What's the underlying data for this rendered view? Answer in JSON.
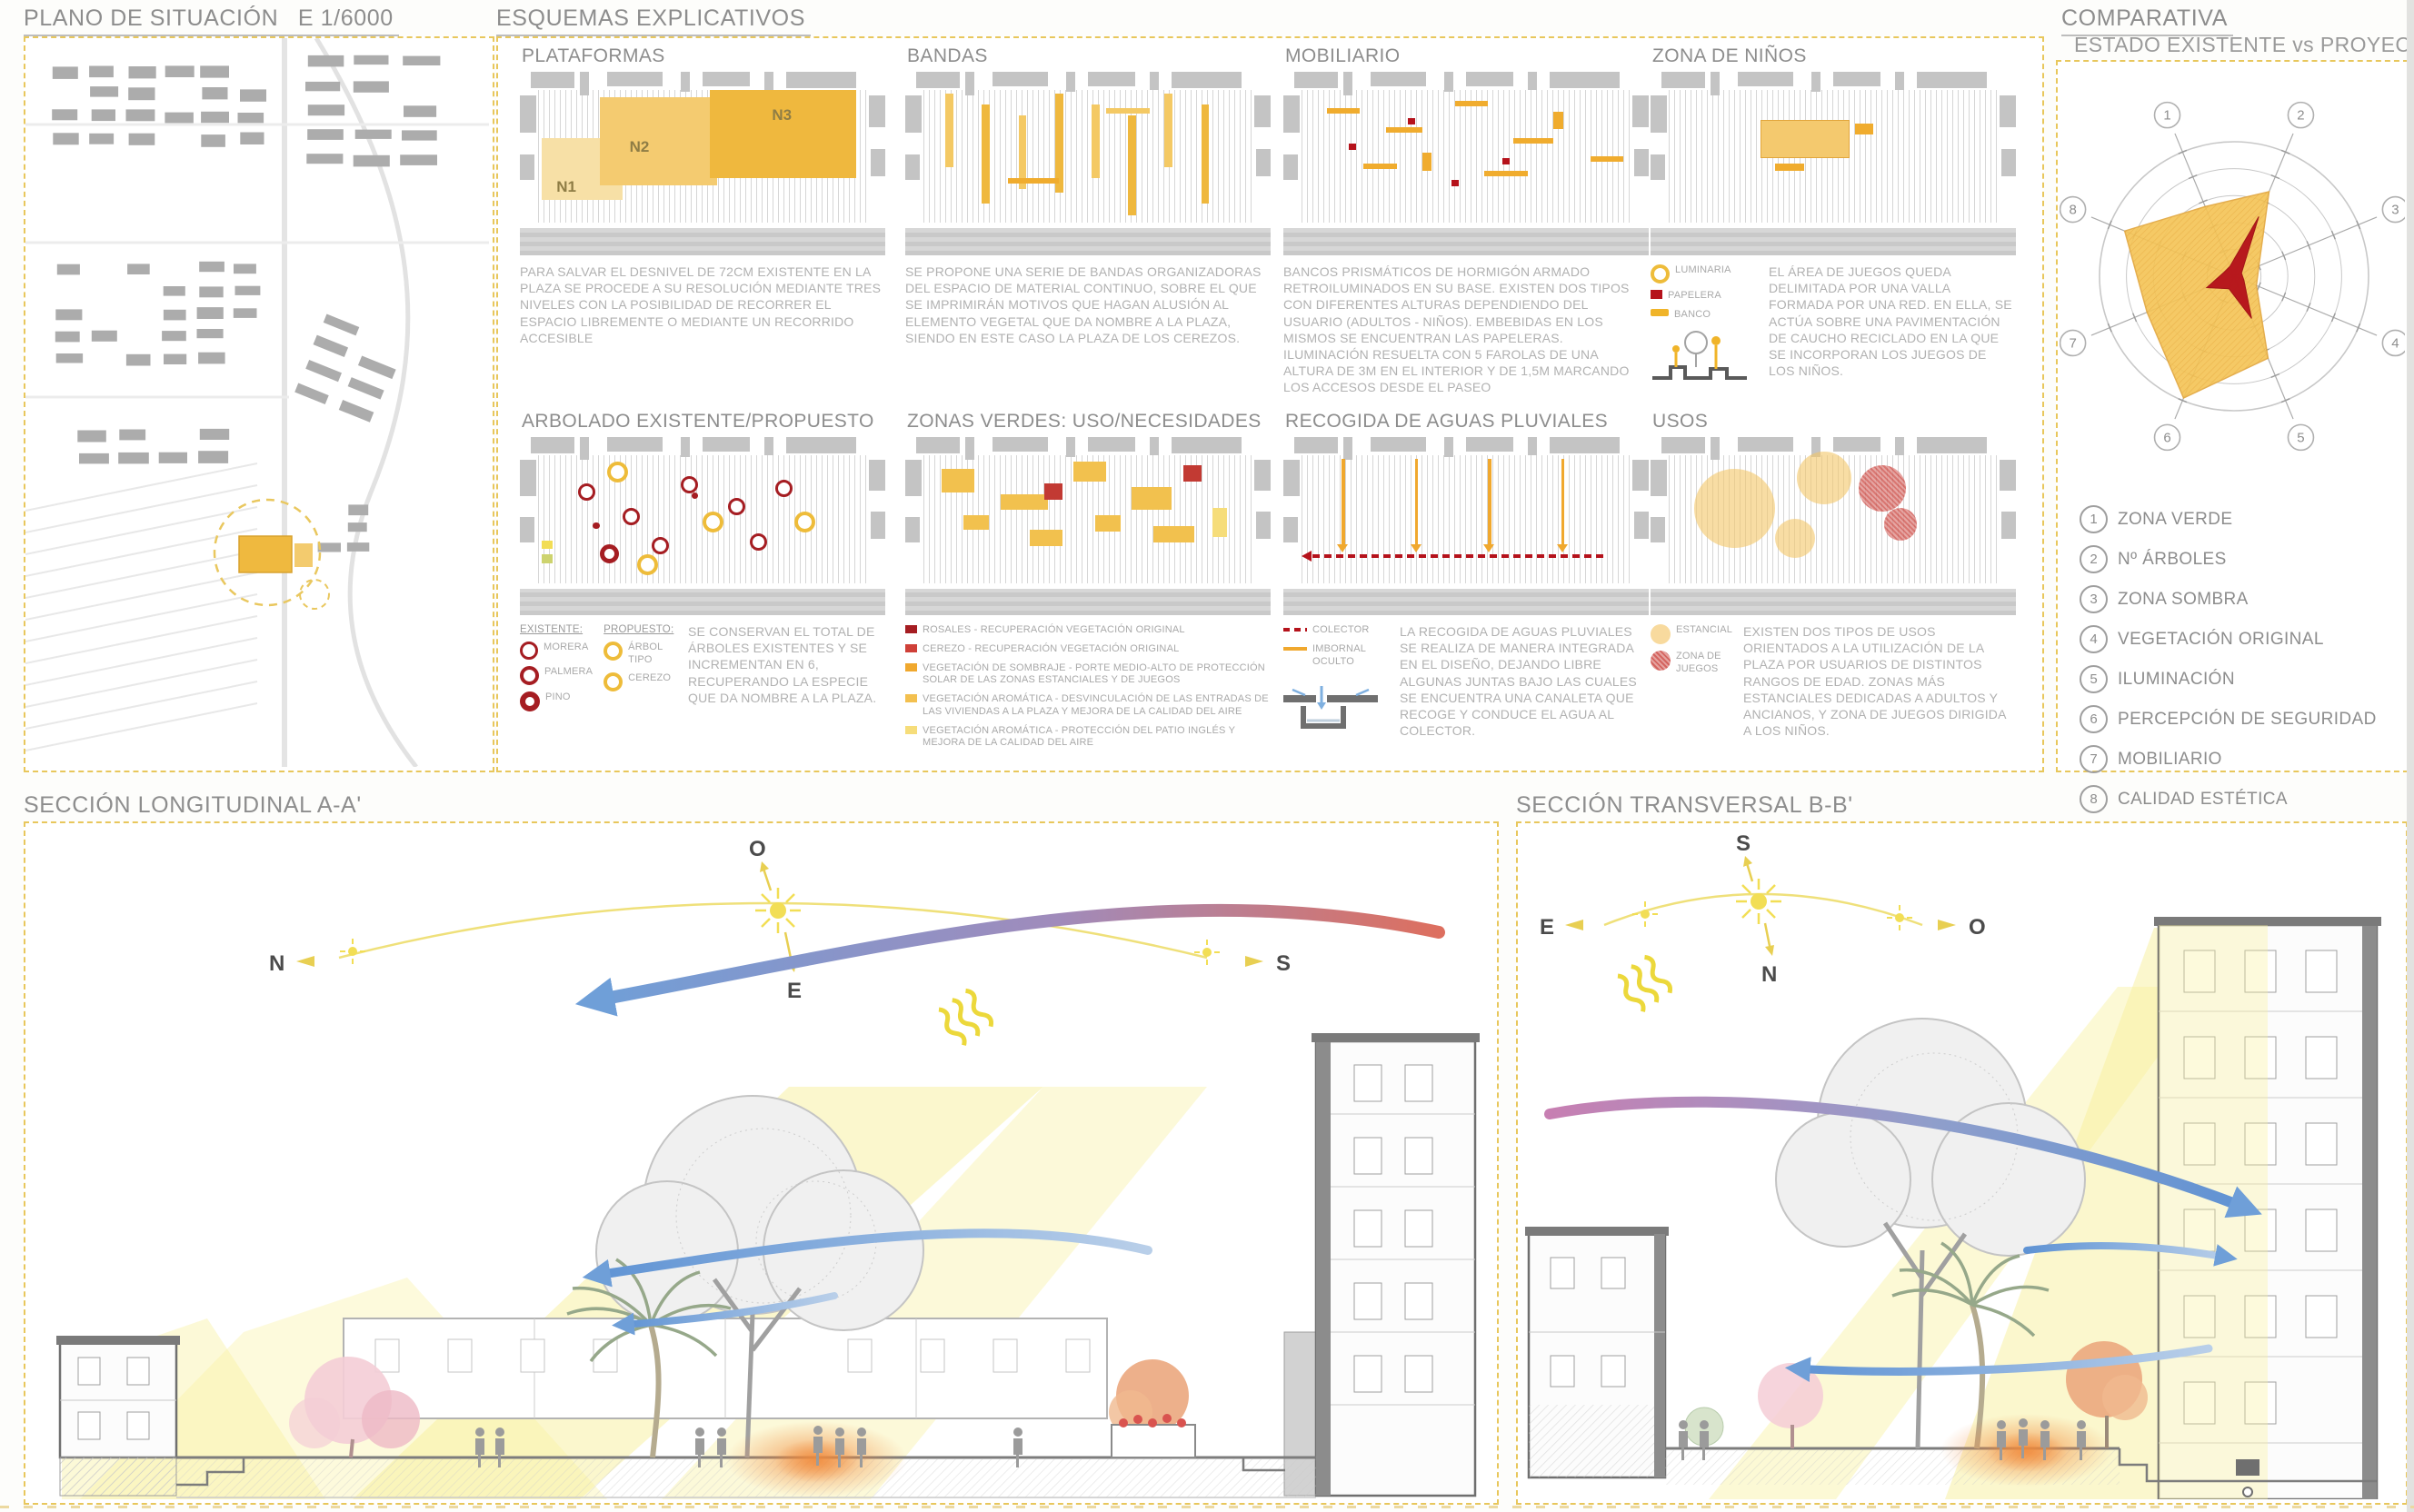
{
  "board": {
    "accent": "#e8c75c"
  },
  "site_plan": {
    "title": "PLANO DE SITUACIÓN",
    "scale": "E 1/6000"
  },
  "esquemas": {
    "title": "ESQUEMAS EXPLICATIVOS",
    "panels": [
      {
        "title": "PLATAFORMAS",
        "labels": [
          "N1",
          "N2",
          "N3"
        ],
        "text": "PARA SALVAR EL DESNIVEL DE 72CM EXISTENTE EN LA PLAZA SE PROCEDE A SU RESOLUCIÓN MEDIANTE TRES NIVELES CON LA POSIBILIDAD DE RECORRER EL ESPACIO LIBREMENTE O MEDIANTE UN RECORRIDO ACCESIBLE"
      },
      {
        "title": "BANDAS",
        "text": "SE PROPONE UNA SERIE DE BANDAS ORGANIZADORAS DEL ESPACIO DE MATERIAL CONTINUO, SOBRE EL QUE SE IMPRIMIRÁN MOTIVOS QUE HAGAN ALUSIÓN AL ELEMENTO VEGETAL QUE DA NOMBRE A LA PLAZA, SIENDO EN ESTE CASO LA PLAZA DE LOS CEREZOS."
      },
      {
        "title": "MOBILIARIO",
        "text": "BANCOS PRISMÁTICOS DE HORMIGÓN ARMADO RETROILUMINADOS EN SU BASE. EXISTEN DOS TIPOS CON DIFERENTES ALTURAS DEPENDIENDO DEL USUARIO (ADULTOS - NIÑOS). EMBEBIDAS EN LOS MISMOS SE ENCUENTRAN LAS PAPELERAS. ILUMINACIÓN RESUELTA CON 5 FAROLAS DE UNA ALTURA DE 3M EN EL INTERIOR Y DE 1,5M MARCANDO LOS ACCESOS DESDE EL PASEO",
        "legend": [
          "LUMINARIA",
          "PAPELERA",
          "BANCO"
        ]
      },
      {
        "title": "ZONA DE NIÑOS",
        "text": "EL ÁREA DE JUEGOS QUEDA DELIMITADA POR UNA VALLA FORMADA POR UNA RED. EN ELLA, SE ACTÚA SOBRE UNA PAVIMENTACIÓN DE CAUCHO RECICLADO EN LA QUE SE INCORPORAN LOS JUEGOS DE LOS NIÑOS."
      },
      {
        "title": "ARBOLADO EXISTENTE/PROPUESTO",
        "text": "SE CONSERVAN EL TOTAL DE ÁRBOLES EXISTENTES Y SE INCREMENTAN EN 6, RECUPERANDO LA ESPECIE QUE DA NOMBRE A LA PLAZA.",
        "legend_existente": {
          "title": "EXISTENTE:",
          "items": [
            "MORERA",
            "PALMERA",
            "PINO"
          ]
        },
        "legend_propuesto": {
          "title": "PROPUESTO:",
          "items": [
            "ÁRBOL TIPO",
            "CEREZO"
          ]
        }
      },
      {
        "title": "ZONAS VERDES: USO/NECESIDADES",
        "legend": [
          "ROSALES - RECUPERACIÓN VEGETACIÓN ORIGINAL",
          "CEREZO - RECUPERACIÓN VEGETACIÓN ORIGINAL",
          "VEGETACIÓN DE SOMBRAJE - PORTE MEDIO-ALTO DE PROTECCIÓN SOLAR DE LAS ZONAS ESTANCIALES Y DE JUEGOS",
          "VEGETACIÓN AROMÁTICA - DESVINCULACIÓN DE LAS ENTRADAS DE LAS VIVIENDAS A LA PLAZA Y MEJORA DE LA CALIDAD DEL AIRE",
          "VEGETACIÓN AROMÁTICA - PROTECCIÓN DEL PATIO INGLÉS Y MEJORA DE LA CALIDAD DEL AIRE"
        ]
      },
      {
        "title": "RECOGIDA DE AGUAS PLUVIALES",
        "legend": [
          "COLECTOR",
          "IMBORNAL OCULTO"
        ],
        "text": "LA RECOGIDA DE AGUAS PLUVIALES SE REALIZA DE MANERA INTEGRADA EN EL DISEÑO, DEJANDO LIBRE ALGUNAS JUNTAS BAJO LAS CUALES SE ENCUENTRA UNA CANALETA QUE RECOGE Y CONDUCE EL AGUA AL COLECTOR.",
        "legend_water_icon": "canaleta-section-icon"
      },
      {
        "title": "USOS",
        "legend": [
          "ESTANCIAL",
          "ZONA DE JUEGOS"
        ],
        "text": "EXISTEN DOS TIPOS DE USOS ORIENTADOS A LA UTILIZACIÓN DE LA PLAZA POR USUARIOS DE DISTINTOS RANGOS DE EDAD. ZONAS MÁS ESTANCIALES DEDICADAS A ADULTOS Y ANCIANOS, Y ZONA DE JUEGOS DIRIGIDA A LOS NIÑOS."
      }
    ]
  },
  "comparativa": {
    "title": "COMPARATIVA",
    "subtitle": "ESTADO EXISTENTE vs PROYECTADO",
    "legend": [
      "ZONA VERDE",
      "Nº ÁRBOLES",
      "ZONA SOMBRA",
      "VEGETACIÓN ORIGINAL",
      "ILUMINACIÓN",
      "PERCEPCIÓN DE SEGURIDAD",
      "MOBILIARIO",
      "CALIDAD ESTÉTICA"
    ]
  },
  "chart_data": {
    "type": "radar",
    "axes": [
      "1",
      "2",
      "3",
      "4",
      "5",
      "6",
      "7",
      "8"
    ],
    "axis_labels": [
      "ZONA VERDE",
      "Nº ÁRBOLES",
      "ZONA SOMBRA",
      "VEGETACIÓN ORIGINAL",
      "ILUMINACIÓN",
      "PERCEPCIÓN DE SEGURIDAD",
      "MOBILIARIO",
      "CALIDAD ESTÉTICA"
    ],
    "rings": 5,
    "scale_max": 5,
    "legend_position": "none",
    "series": [
      {
        "name": "PROYECTADO",
        "color": "#f5c455",
        "values": [
          2.8,
          3.4,
          1.0,
          0.9,
          3.3,
          4.9,
          3.5,
          4.4
        ]
      },
      {
        "name": "ESTADO EXISTENTE",
        "color": "#b5121b",
        "values": [
          0.4,
          2.4,
          0.3,
          0.4,
          1.7,
          0.5,
          1.1,
          0.4
        ]
      }
    ]
  },
  "secciones": {
    "longitudinal": {
      "title": "SECCIÓN LONGITUDINAL A-A'",
      "compass": [
        "N",
        "O",
        "E",
        "S"
      ]
    },
    "transversal": {
      "title": "SECCIÓN TRANSVERSAL B-B'",
      "compass": [
        "E",
        "S",
        "N",
        "O"
      ]
    }
  }
}
